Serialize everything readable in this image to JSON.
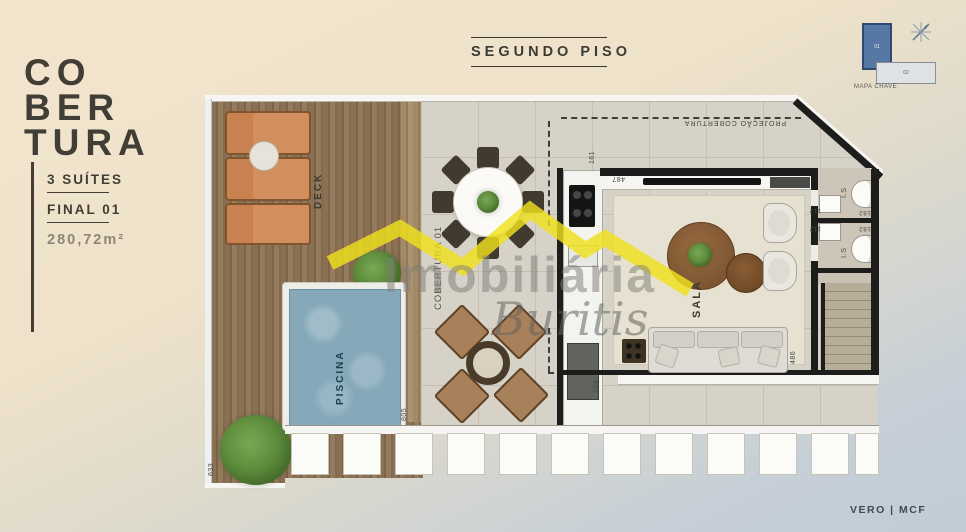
{
  "sidebar": {
    "title_lines": [
      "CO",
      "BER",
      "TURA"
    ],
    "suites": "3 SUÍTES",
    "final": "FINAL 01",
    "area": "280,72m²"
  },
  "header": {
    "title": "SEGUNDO PISO"
  },
  "keyplan": {
    "caption": "MAPA CHAVE",
    "unit_highlight": "01",
    "unit_other": "02"
  },
  "watermark": {
    "brand": "Imobiliária",
    "script": "Buritis"
  },
  "plan": {
    "labels": {
      "deck": "DECK",
      "piscina": "PISCINA",
      "sala": "SALA",
      "cobertura_unit": "COBERTURA 01",
      "projecao": "PROJEÇÃO COBERTURA",
      "is_1": "I.S",
      "is_2": "I.S"
    },
    "dims": {
      "d161": "161",
      "d487": "487",
      "d112_1": "112",
      "d112_2": "112",
      "d182_1": "182",
      "d182_2": "182",
      "d124": "124",
      "d486": "486",
      "d805": "805",
      "d633": "633",
      "d1645": "1645"
    }
  },
  "footer": {
    "brand": "VERO | MCF"
  },
  "colors": {
    "accent_yellow": "#efe01c",
    "pool_blue": "#86a9ba",
    "keyplan_blue": "#5578a5",
    "wall_black": "#1d1d1b",
    "deck_wood": "#8b7154",
    "lounge_orange": "#d28e5c"
  }
}
